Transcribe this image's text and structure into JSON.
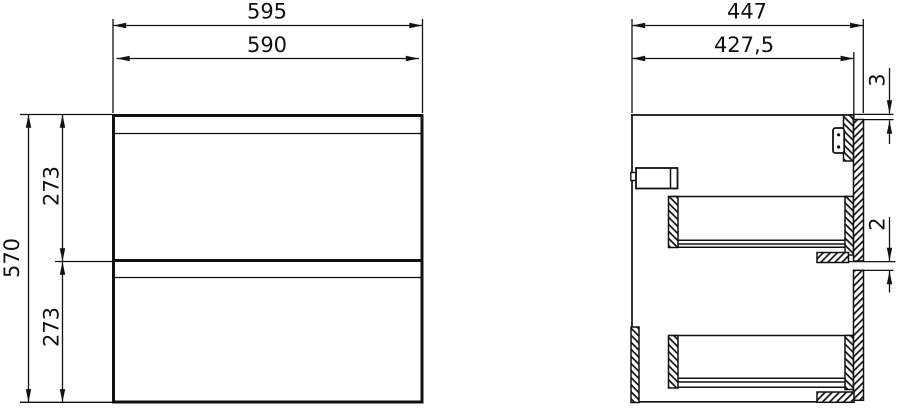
{
  "drawing_title": "cabinet-two-drawer-dimension-drawing",
  "views": {
    "front": {
      "label": "front-view",
      "dims": {
        "width_overall": "595",
        "width_carcass": "590",
        "height_overall": "570",
        "drawer_front_upper": "273",
        "drawer_front_lower": "273"
      }
    },
    "side": {
      "label": "side-view-section",
      "dims": {
        "depth_overall": "447",
        "depth_carcass": "427,5",
        "top_reveal": "3",
        "drawer_gap": "2"
      }
    }
  },
  "colors": {
    "line": "#111111",
    "background": "#ffffff"
  }
}
